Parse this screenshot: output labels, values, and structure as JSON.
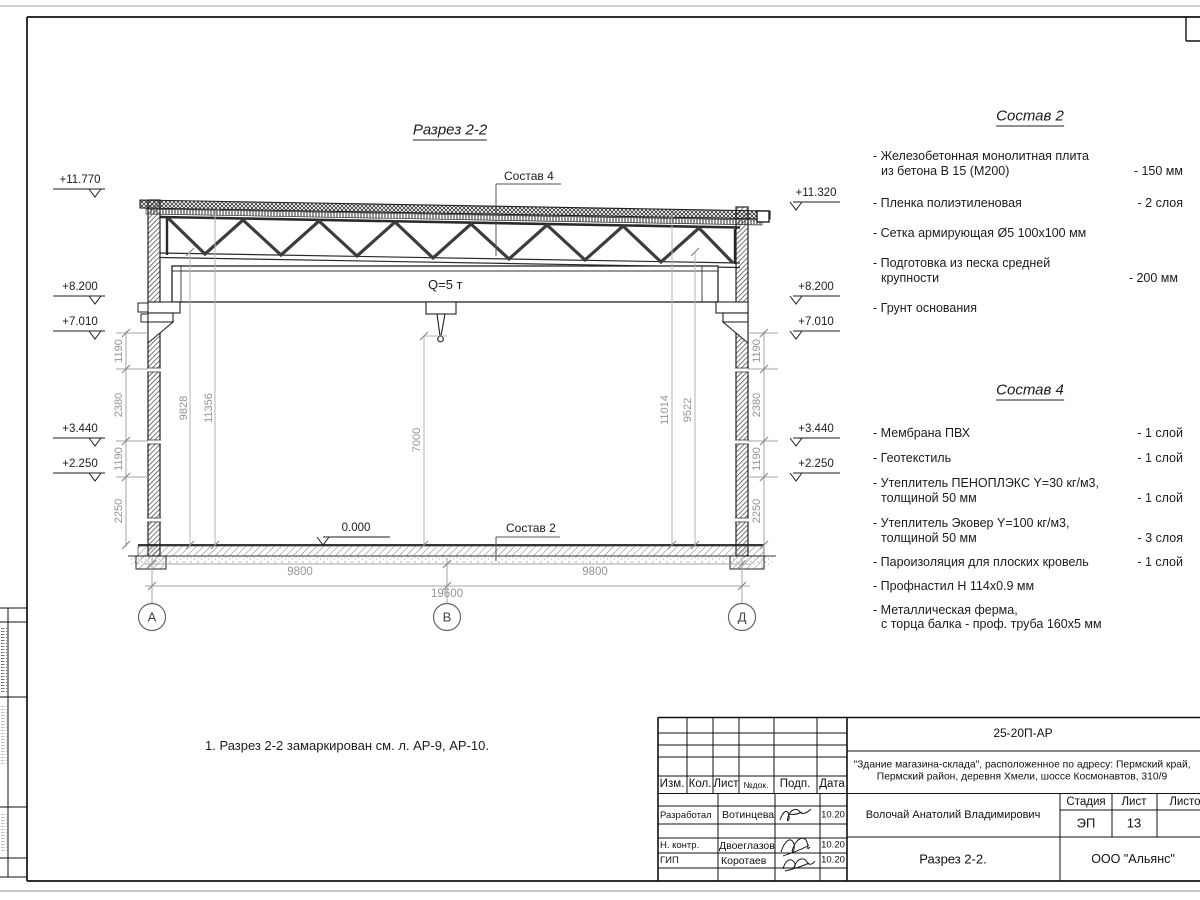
{
  "drawing": {
    "title": "Разрез 2-2",
    "crane_label": "Q=5 т",
    "zero_mark": "0.000",
    "sostav2_ref": "Состав 2",
    "sostav4_ref": "Состав 4",
    "note": "1. Разрез 2-2 замаркирован см. л. АР-9, АР-10.",
    "axes": [
      "А",
      "В",
      "Д"
    ],
    "elevations_left": [
      "+11.770",
      "+8.200",
      "+7.010",
      "+3.440",
      "+2.250"
    ],
    "elevations_right": [
      "+11.320",
      "+8.200",
      "+7.010",
      "+3.440",
      "+2.250"
    ],
    "dims_left": [
      "1190",
      "2380",
      "1190",
      "2250"
    ],
    "dims_right": [
      "1190",
      "2380",
      "1190",
      "2250"
    ],
    "dims_interior": [
      "9828",
      "11356",
      "7000",
      "11014",
      "9522"
    ],
    "dims_bottom": [
      "9800",
      "9800",
      "19600"
    ]
  },
  "sostav2": {
    "title": "Состав 2",
    "items": [
      {
        "t1": "- Железобетонная  монолитная плита",
        "t2": "из бетона В 15 (М200)",
        "v": "- 150 мм"
      },
      {
        "t1": "- Пленка полиэтиленовая",
        "v": "-  2 слоя"
      },
      {
        "t1": "- Сетка армирующая Ø5 100х100 мм"
      },
      {
        "t1": "- Подготовка из песка средней",
        "t2": "крупности",
        "v": "- 200 мм"
      },
      {
        "t1": "- Грунт основания"
      }
    ]
  },
  "sostav4": {
    "title": "Состав 4",
    "items": [
      {
        "t1": "- Мембрана ПВХ",
        "v": "- 1 слой"
      },
      {
        "t1": "- Геотекстиль",
        "v": "- 1 слой"
      },
      {
        "t1": "- Утеплитель ПЕНОПЛЭКС Y=30 кг/м3,",
        "t2": "толщиной 50 мм",
        "v": "- 1 слой"
      },
      {
        "t1": "- Утеплитель Эковер Y=100 кг/м3,",
        "t2": "толщиной 50 мм",
        "v": "- 3 слоя"
      },
      {
        "t1": "- Пароизоляция для плоских кровель",
        "v": "- 1 слой"
      },
      {
        "t1": "- Профнастил Н 114х0.9 мм"
      },
      {
        "t1": "- Металлическая ферма,",
        "t2": "с торца балка - проф. труба 160х5 мм"
      }
    ]
  },
  "title_block": {
    "doc_code": "25-20П-АР",
    "address_line1": "\"Здание магазина-склада\", расположенное по адресу: Пермский край,",
    "address_line2": "Пермский район, деревня Хмели, шоссе Космонавтов, 310/9",
    "header": {
      "izm": "Изм.",
      "kol": "Кол.",
      "list": "Лист",
      "ndok": "№док.",
      "podp": "Подп.",
      "data": "Дата"
    },
    "rows": [
      {
        "role": "Разработал",
        "name": "Вотинцева",
        "date": "10.20"
      },
      {
        "role": "Н. контр.",
        "name": "Двоеглазов",
        "date": "10.20"
      },
      {
        "role": "ГИП",
        "name": "Коротаев",
        "date": "10.20"
      }
    ],
    "author": "Волочай Анатолий Владимирович",
    "stage_label": "Стадия",
    "sheet_label": "Лист",
    "sheets_label": "Листов",
    "stage": "ЭП",
    "sheet_no": "13",
    "sheet_name": "Разрез 2-2.",
    "org": "ООО \"Альянс\""
  }
}
